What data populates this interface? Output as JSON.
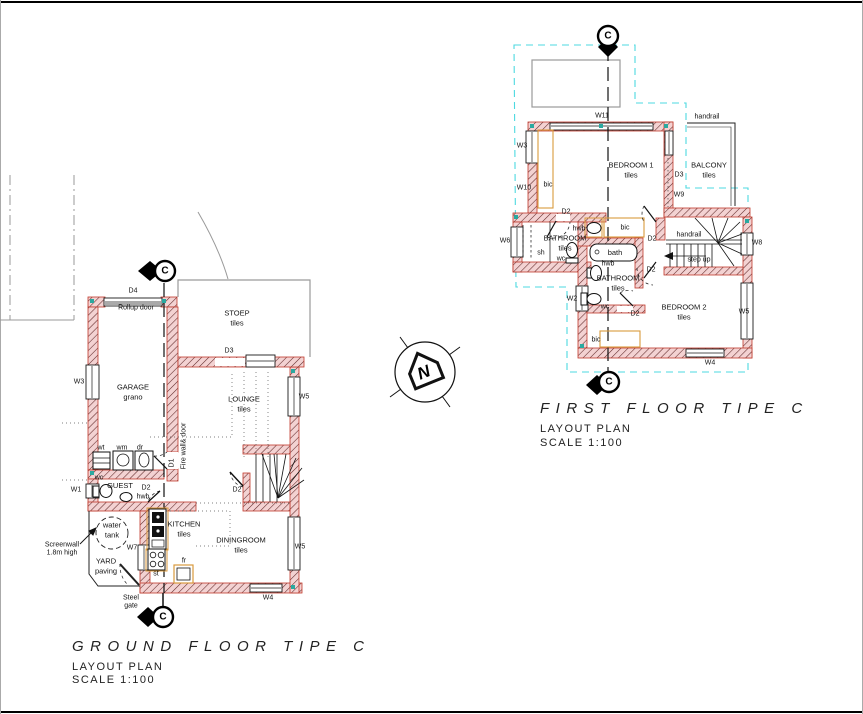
{
  "page": {
    "background": "#ffffff",
    "border_color": "#000000"
  },
  "colors": {
    "wall_fill": "#f3d2d2",
    "wall_hatch": "#5f2727",
    "wall_stroke": "#c0392b",
    "cyan_dash": "#4dd9e0",
    "tan_fixture": "#d99a3d",
    "gray_line": "#9a9a9a",
    "teal_mark": "#2aa9a0"
  },
  "north": {
    "label": "N"
  },
  "section_marker": {
    "label": "C"
  },
  "ground_floor": {
    "title": "GROUND FLOOR TIPE C",
    "subtitle": "LAYOUT PLAN",
    "scale": "SCALE 1:100",
    "rooms": [
      {
        "name": "room-garage",
        "lines": [
          "GARAGE",
          "grano"
        ],
        "x": 133,
        "y": 392
      },
      {
        "name": "room-stoep",
        "lines": [
          "STOEP",
          "tiles"
        ],
        "x": 237,
        "y": 318
      },
      {
        "name": "room-lounge",
        "lines": [
          "LOUNGE",
          "tiles"
        ],
        "x": 244,
        "y": 404
      },
      {
        "name": "room-kitchen",
        "lines": [
          "KITCHEN",
          "tiles"
        ],
        "x": 184,
        "y": 529
      },
      {
        "name": "room-diningroom",
        "lines": [
          "DININGROOM",
          "tiles"
        ],
        "x": 241,
        "y": 545
      },
      {
        "name": "room-guest",
        "lines": [
          "GUEST"
        ],
        "x": 120,
        "y": 486
      },
      {
        "name": "room-yard",
        "lines": [
          "YARD",
          "paving"
        ],
        "x": 106,
        "y": 566
      },
      {
        "name": "room-water-tank",
        "lines": [
          "water",
          "tank"
        ],
        "x": 112,
        "y": 530
      }
    ],
    "labels": [
      {
        "name": "window-w3",
        "text": "W3",
        "x": 79,
        "y": 382
      },
      {
        "name": "window-w1",
        "text": "W1",
        "x": 76,
        "y": 490
      },
      {
        "name": "window-w7",
        "text": "W7",
        "x": 132,
        "y": 548
      },
      {
        "name": "window-w5-lounge",
        "text": "W5",
        "x": 304,
        "y": 397
      },
      {
        "name": "window-w5-dining",
        "text": "W5",
        "x": 300,
        "y": 547
      },
      {
        "name": "window-w4",
        "text": "W4",
        "x": 268,
        "y": 598
      },
      {
        "name": "door-d4",
        "text": "D4",
        "x": 133,
        "y": 291
      },
      {
        "name": "rollup-door",
        "text": "Rollup door",
        "x": 136,
        "y": 308
      },
      {
        "name": "door-d3",
        "text": "D3",
        "x": 229,
        "y": 351
      },
      {
        "name": "door-d1",
        "text": "D1",
        "x": 172,
        "y": 463,
        "rot": -90
      },
      {
        "name": "door-d2-guest",
        "text": "D2",
        "x": 146,
        "y": 488
      },
      {
        "name": "door-d2-stairs",
        "text": "D2",
        "x": 237,
        "y": 490
      },
      {
        "name": "fixture-wt",
        "text": "wt",
        "x": 101,
        "y": 448
      },
      {
        "name": "fixture-wm",
        "text": "wm",
        "x": 122,
        "y": 448
      },
      {
        "name": "fixture-dr",
        "text": "dr",
        "x": 140,
        "y": 448
      },
      {
        "name": "fixture-wc",
        "text": "wc",
        "x": 99,
        "y": 478
      },
      {
        "name": "fixture-hwb",
        "text": "hwb",
        "x": 143,
        "y": 497
      },
      {
        "name": "fixture-st",
        "text": "st",
        "x": 156,
        "y": 574
      },
      {
        "name": "fixture-fr",
        "text": "fr",
        "x": 184,
        "y": 561
      },
      {
        "name": "firewall-note",
        "text": "Fire wall& door",
        "x": 184,
        "y": 446,
        "rot": -90
      },
      {
        "name": "screenwall-note-1",
        "text": "Screenwall",
        "x": 62,
        "y": 545
      },
      {
        "name": "screenwall-note-2",
        "text": "1.8m high",
        "x": 62,
        "y": 553
      },
      {
        "name": "steel-gate-note-1",
        "text": "Steel",
        "x": 131,
        "y": 598
      },
      {
        "name": "steel-gate-note-2",
        "text": "gate",
        "x": 131,
        "y": 606
      }
    ]
  },
  "first_floor": {
    "title": "FIRST FLOOR TIPE C",
    "subtitle": "LAYOUT PLAN",
    "scale": "SCALE 1:100",
    "rooms": [
      {
        "name": "room-bedroom1",
        "lines": [
          "BEDROOM 1",
          "tiles"
        ],
        "x": 631,
        "y": 170
      },
      {
        "name": "room-balcony",
        "lines": [
          "BALCONY",
          "tiles"
        ],
        "x": 709,
        "y": 170
      },
      {
        "name": "room-bathroom1",
        "lines": [
          "BATHROOM",
          "tiles"
        ],
        "x": 565,
        "y": 243
      },
      {
        "name": "room-bathroom2",
        "lines": [
          "BATHROOM",
          "tiles"
        ],
        "x": 618,
        "y": 283
      },
      {
        "name": "room-bedroom2",
        "lines": [
          "BEDROOM 2",
          "tiles"
        ],
        "x": 684,
        "y": 312
      },
      {
        "name": "fixture-bath",
        "lines": [
          "bath"
        ],
        "x": 615,
        "y": 253
      }
    ],
    "labels": [
      {
        "name": "window-w11",
        "text": "W11",
        "x": 602,
        "y": 116
      },
      {
        "name": "handrail-balcony",
        "text": "handrail",
        "x": 707,
        "y": 117
      },
      {
        "name": "window-w3-ff",
        "text": "W3",
        "x": 522,
        "y": 146
      },
      {
        "name": "window-w10",
        "text": "W10",
        "x": 524,
        "y": 188
      },
      {
        "name": "fixture-bic-bed1",
        "text": "bic",
        "x": 548,
        "y": 185
      },
      {
        "name": "door-d3-balcony",
        "text": "D3",
        "x": 679,
        "y": 175
      },
      {
        "name": "window-w9",
        "text": "W9",
        "x": 679,
        "y": 195
      },
      {
        "name": "window-w6",
        "text": "W6",
        "x": 505,
        "y": 241
      },
      {
        "name": "door-d2-bath1",
        "text": "D2",
        "x": 566,
        "y": 212
      },
      {
        "name": "fixture-hwb-bath1",
        "text": "hwb",
        "x": 579,
        "y": 229
      },
      {
        "name": "fixture-sh",
        "text": "sh",
        "x": 541,
        "y": 253
      },
      {
        "name": "fixture-wc-bath1",
        "text": "wc",
        "x": 561,
        "y": 259
      },
      {
        "name": "fixture-bic-center",
        "text": "bic",
        "x": 625,
        "y": 228
      },
      {
        "name": "door-d2-bed1",
        "text": "D2",
        "x": 652,
        "y": 239
      },
      {
        "name": "handrail-stairs",
        "text": "handrail",
        "x": 689,
        "y": 235
      },
      {
        "name": "step-up-note",
        "text": "step up",
        "x": 699,
        "y": 260
      },
      {
        "name": "window-w8",
        "text": "W8",
        "x": 757,
        "y": 243
      },
      {
        "name": "door-d2-hall",
        "text": "D2",
        "x": 651,
        "y": 270
      },
      {
        "name": "fixture-hwb-bath2",
        "text": "hwb",
        "x": 608,
        "y": 264
      },
      {
        "name": "window-w2",
        "text": "W2",
        "x": 572,
        "y": 299
      },
      {
        "name": "fixture-wc-bath2",
        "text": "wc",
        "x": 605,
        "y": 307
      },
      {
        "name": "door-d2-bath2",
        "text": "D2",
        "x": 635,
        "y": 314
      },
      {
        "name": "window-w5-ff",
        "text": "W5",
        "x": 744,
        "y": 312
      },
      {
        "name": "fixture-bic-bed2",
        "text": "bic",
        "x": 596,
        "y": 340
      },
      {
        "name": "window-w4-ff",
        "text": "W4",
        "x": 710,
        "y": 363
      }
    ]
  }
}
